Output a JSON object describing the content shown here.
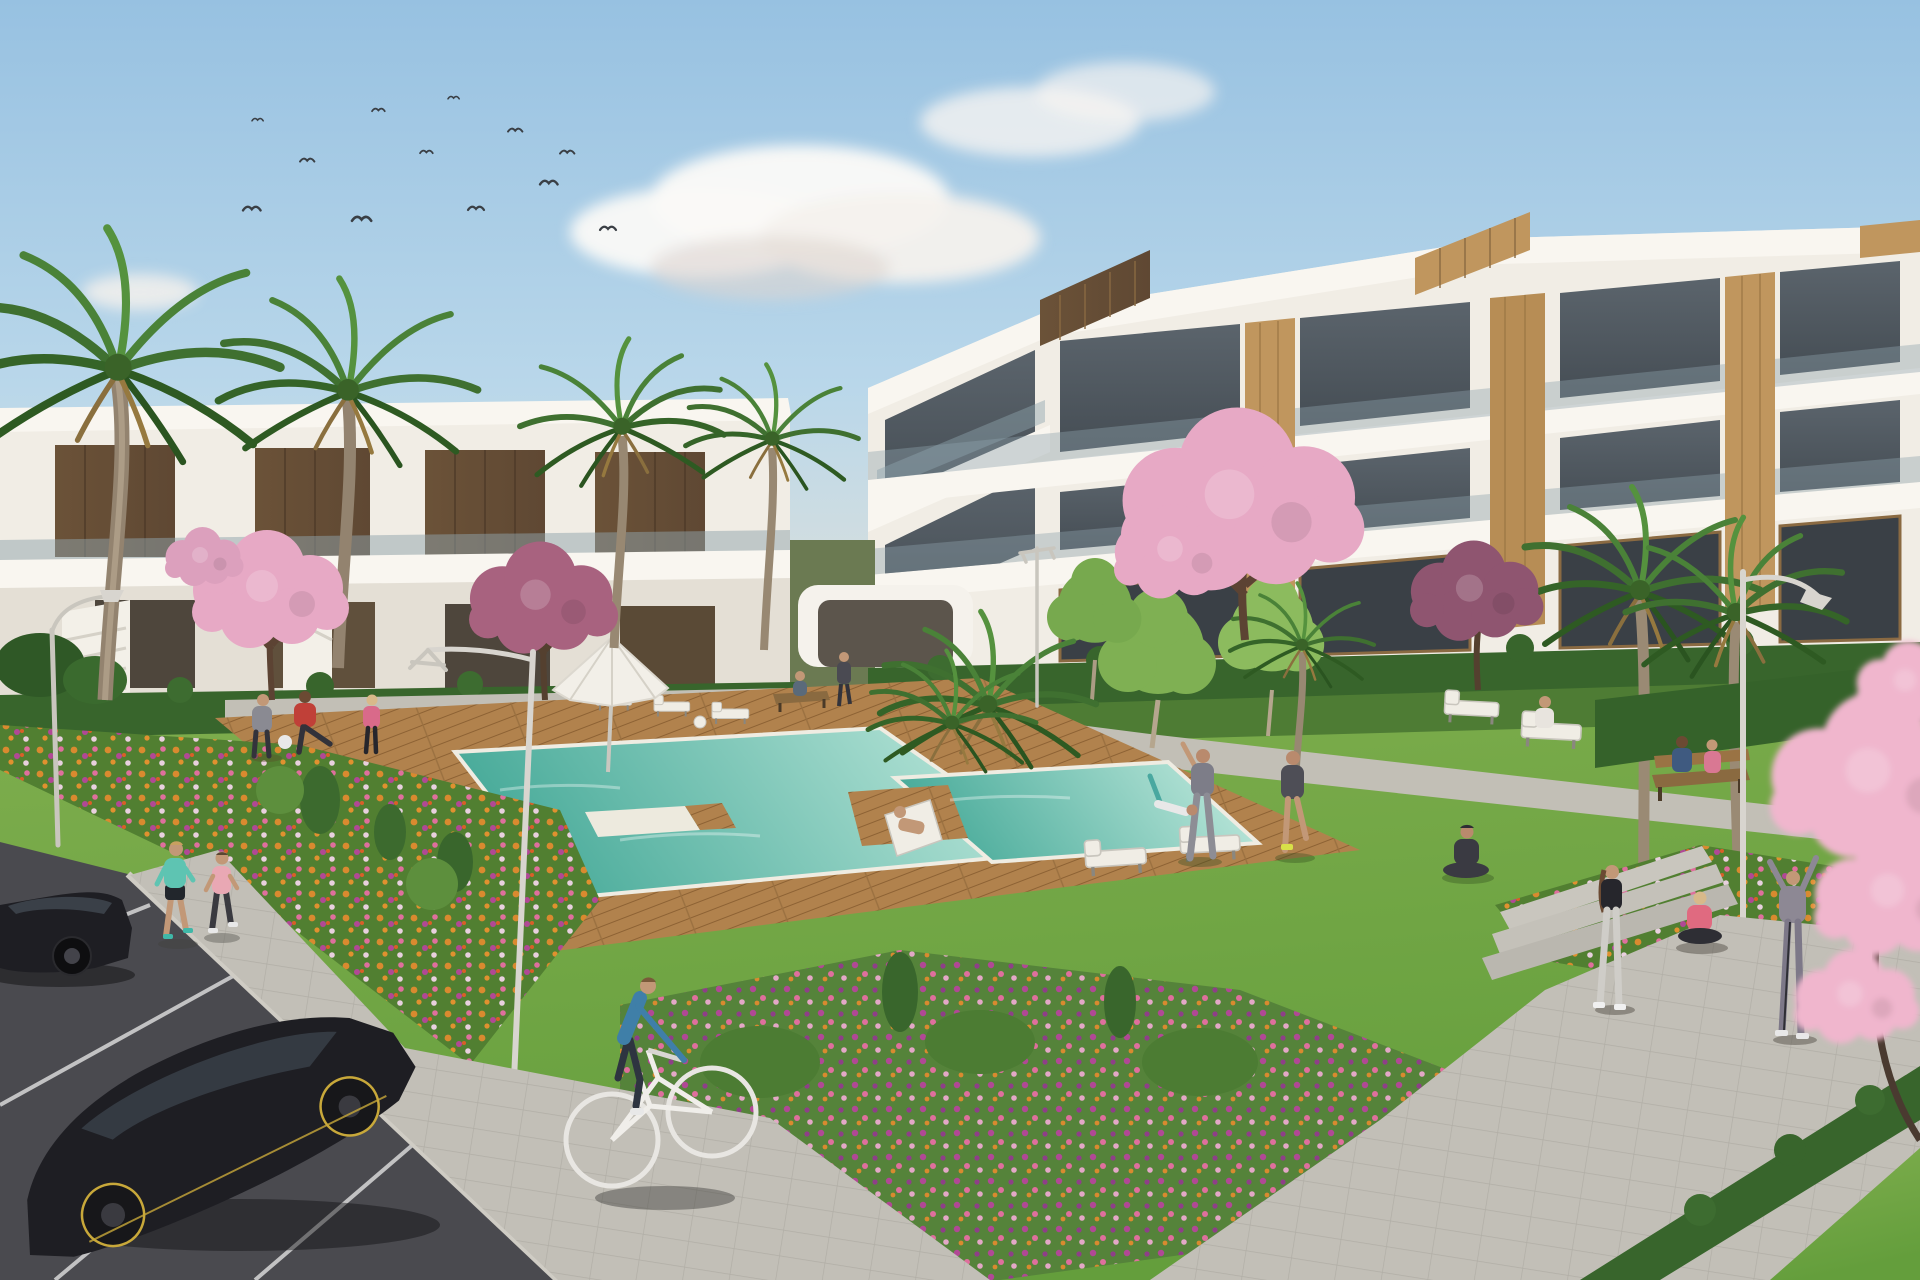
{
  "scene": {
    "description": "Sunny 3D architectural rendering of a modern white apartment complex with communal gardens, a swimming pool on a wooden deck, exercising residents, joggers, a cyclist, parked black cars, palm and cherry-blossom trees and colorful flower beds",
    "time_of_day": "day",
    "sky": {
      "birds_count": 12,
      "clouds": "scattered cumulus"
    },
    "objects": [
      "apartment buildings",
      "palm trees",
      "cherry blossom trees",
      "swimming pool",
      "wood deck",
      "sun loungers",
      "parasol",
      "street lamps",
      "benches",
      "flower beds",
      "lawn",
      "paved paths",
      "parking lot",
      "black cars",
      "joggers",
      "cyclist",
      "exercise groups",
      "concrete steps"
    ]
  },
  "colors": {
    "sky_top": "#97c1e1",
    "sky_mid": "#b9d7ea",
    "sky_horizon": "#e6e3d8",
    "cloud": "#faf9f7",
    "building_white": "#f1ede5",
    "slab_white": "#f9f6f0",
    "glass_dark": "#454d54",
    "glass_rail": "#8fa3ac",
    "wood_dark": "#5f4833",
    "wood_accent": "#c0965e",
    "grass_light": "#7fae4e",
    "grass_deep": "#649e3c",
    "hedge": "#38652c",
    "tree_green": "#7fb053",
    "palm_green": "#49803a",
    "blossom_pink": "#e7a9c5",
    "blossom_plum": "#a8627f",
    "blossom_foreground": "#f0b6cd",
    "flower_orange": "#d98a2f",
    "flower_pink": "#df6f9d",
    "flower_magenta": "#b14895",
    "pool_deep": "#49ab9a",
    "pool_shallow": "#c6ece0",
    "deck_wood": "#b1824d",
    "path_gray": "#c2bfb7",
    "asphalt": "#4a4a4f",
    "curb": "#cfccc4",
    "car_black": "#1e1e23",
    "lamp_metal": "#d8d5cf",
    "steps": "#c9c6be",
    "skin": "#c29877"
  }
}
